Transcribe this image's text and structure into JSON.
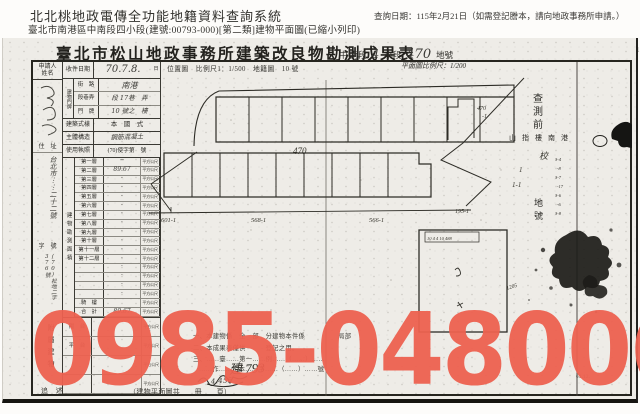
{
  "watermark": {
    "text": "0985-048006",
    "color": "#ed6150"
  },
  "header": {
    "system_title": "北北桃地政電傳全功能地籍資料查詢系統",
    "query_info": "查詢日期：115年2月21日（如需登記謄本，請向地政事務所申請。）",
    "document_line": "臺北市南港區中南段四小段(建號:00793-000)[第二類]建物平面圖(已縮小列印)"
  },
  "document": {
    "title": "臺北市松山地政事務所建築改良物勘測成果表",
    "section": {
      "prefix": "中 南段",
      "number": "4",
      "small_section": "小段",
      "parcel": "470",
      "parcel_label": "地號"
    },
    "location_header": "位置圖　比例尺1：1/500　地籍圖　10 號",
    "plan_scale": "平面圖比例尺：1/200",
    "form": {
      "applicant_label": "申請人",
      "name_label": "姓名",
      "address_label": "住　址",
      "address": "台北市⋯⋯二十二號",
      "docno_label": "字　號",
      "docno": "(70)松地二字376號",
      "attach_label": "附屬建物",
      "received_label": "收件日期",
      "received_date": "70.7.8.",
      "received_suffix": "日",
      "door_group_label": "建物門牌",
      "street_label": "街　路",
      "street": "南港",
      "lane_label": "段巷弄",
      "lane": "段 17巷　弄",
      "door_label": "門　牌",
      "door": "10 號之　樓",
      "style_label": "建築式樣",
      "style": "本　國　式",
      "structure_label": "主體構造",
      "structure": "鋼筋混凝土",
      "license_label": "使用執照",
      "license": "(70)使字第　號",
      "area_group_label": "建物勘測面積",
      "area_unit": "平方公尺",
      "floors": [
        {
          "label": "第一層",
          "value": "─"
        },
        {
          "label": "第二層",
          "value": "89.67"
        },
        {
          "label": "第三層",
          "value": "·"
        },
        {
          "label": "第四層",
          "value": "·"
        },
        {
          "label": "第五層",
          "value": "·"
        },
        {
          "label": "第六層",
          "value": "·"
        },
        {
          "label": "第七層",
          "value": "·"
        },
        {
          "label": "第八層",
          "value": "·"
        },
        {
          "label": "第九層",
          "value": "·"
        },
        {
          "label": "第十層",
          "value": "·"
        },
        {
          "label": "第十一層",
          "value": "·"
        },
        {
          "label": "第十二層",
          "value": "·"
        },
        {
          "label": "",
          "value": "·"
        },
        {
          "label": "",
          "value": "·"
        },
        {
          "label": "",
          "value": "·"
        },
        {
          "label": "",
          "value": "·"
        },
        {
          "label": "騎　樓",
          "value": ""
        },
        {
          "label": "合　計",
          "value": "89.67"
        }
      ],
      "attachments": [
        {
          "label": "陽　台",
          "value": ""
        },
        {
          "label": "平　台",
          "value": ""
        },
        {
          "label": "",
          "value": ""
        },
        {
          "label": "",
          "value": ""
        }
      ]
    },
    "drawing": {
      "parcel_center": "470",
      "parcel_left": "601-1",
      "parcel_mid": "568-1",
      "parcel_right": "566-1",
      "parcel_far": "195-1",
      "parcel_upper": "470",
      "parcel_upper_sub": "-1",
      "survey_note_1": "查",
      "survey_note_2": "測",
      "survey_note_3": "前",
      "stamp_row": [
        "山",
        "指",
        "樓",
        "南",
        "港"
      ],
      "check_char": "校",
      "mark_1": "1",
      "mark_1_1": "1-1",
      "parcel_word_1": "地",
      "parcel_word_2": "號",
      "tiny_col": [
        "3-4",
        "-8",
        "3-7",
        "-17",
        "3-6",
        "-6",
        "3-8"
      ],
      "detail_note": "1205",
      "detail_dims": "10 4 4 10 488"
    },
    "notes": {
      "line1": "一、本建物係　全　部　分建物本件係　　　　　局部",
      "line2": "二、本成果表僅供　　　登記之用。",
      "line3": "三、……臺……第一……例……（……）……",
      "line4": "……作……定本……字……（……）……號",
      "hand_no": "建 793",
      "hand_scribble": "4.455",
      "left_mark": "追　述",
      "page_note": "（建物平面圖共　　冊　　頁）",
      "date_small": "69.12."
    },
    "margin_marks": {
      "left": ",",
      "right": "1"
    }
  }
}
